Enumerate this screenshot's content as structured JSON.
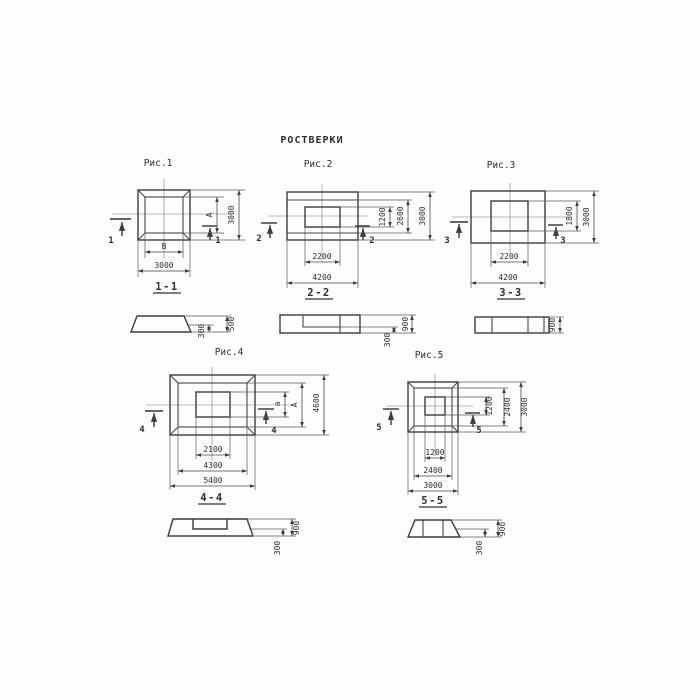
{
  "page": {
    "title": "РОСТВЕРКИ"
  },
  "figures": [
    {
      "id": "fig1",
      "label": "Рис.1",
      "marker": "1",
      "dims": {
        "inner_height": "A",
        "outer_height": "3000",
        "inner_width": "B",
        "outer_width": "3000"
      },
      "section": {
        "label": "1-1",
        "height": "500",
        "ledge": "300"
      }
    },
    {
      "id": "fig2",
      "label": "Рис.2",
      "marker": "2",
      "dims": {
        "recess_height": "1200",
        "inner_height": "2600",
        "outer_height": "3000",
        "recess_width": "2200",
        "outer_width": "4200"
      },
      "section": {
        "label": "2-2",
        "height": "900",
        "ledge": "300"
      }
    },
    {
      "id": "fig3",
      "label": "Рис.3",
      "marker": "3",
      "dims": {
        "inner_height": "1800",
        "outer_height": "3000",
        "inner_width": "2200",
        "outer_width": "4200"
      },
      "section": {
        "label": "3-3",
        "height": "900"
      }
    },
    {
      "id": "fig4",
      "label": "Рис.4",
      "marker": "4",
      "dims": {
        "recess_height": "a",
        "inner_height": "A",
        "outer_height": "4600",
        "recess_width": "2100",
        "inner_width": "4300",
        "outer_width": "5400"
      },
      "section": {
        "label": "4-4",
        "height": "900",
        "ledge": "300"
      }
    },
    {
      "id": "fig5",
      "label": "Рис.5",
      "marker": "5",
      "dims": {
        "recess_height": "1200",
        "inner_height": "2400",
        "outer_height": "3000",
        "recess_width": "1200",
        "inner_width": "2400",
        "outer_width": "3000"
      },
      "section": {
        "label": "5-5",
        "height": "900",
        "ledge": "300"
      }
    }
  ]
}
